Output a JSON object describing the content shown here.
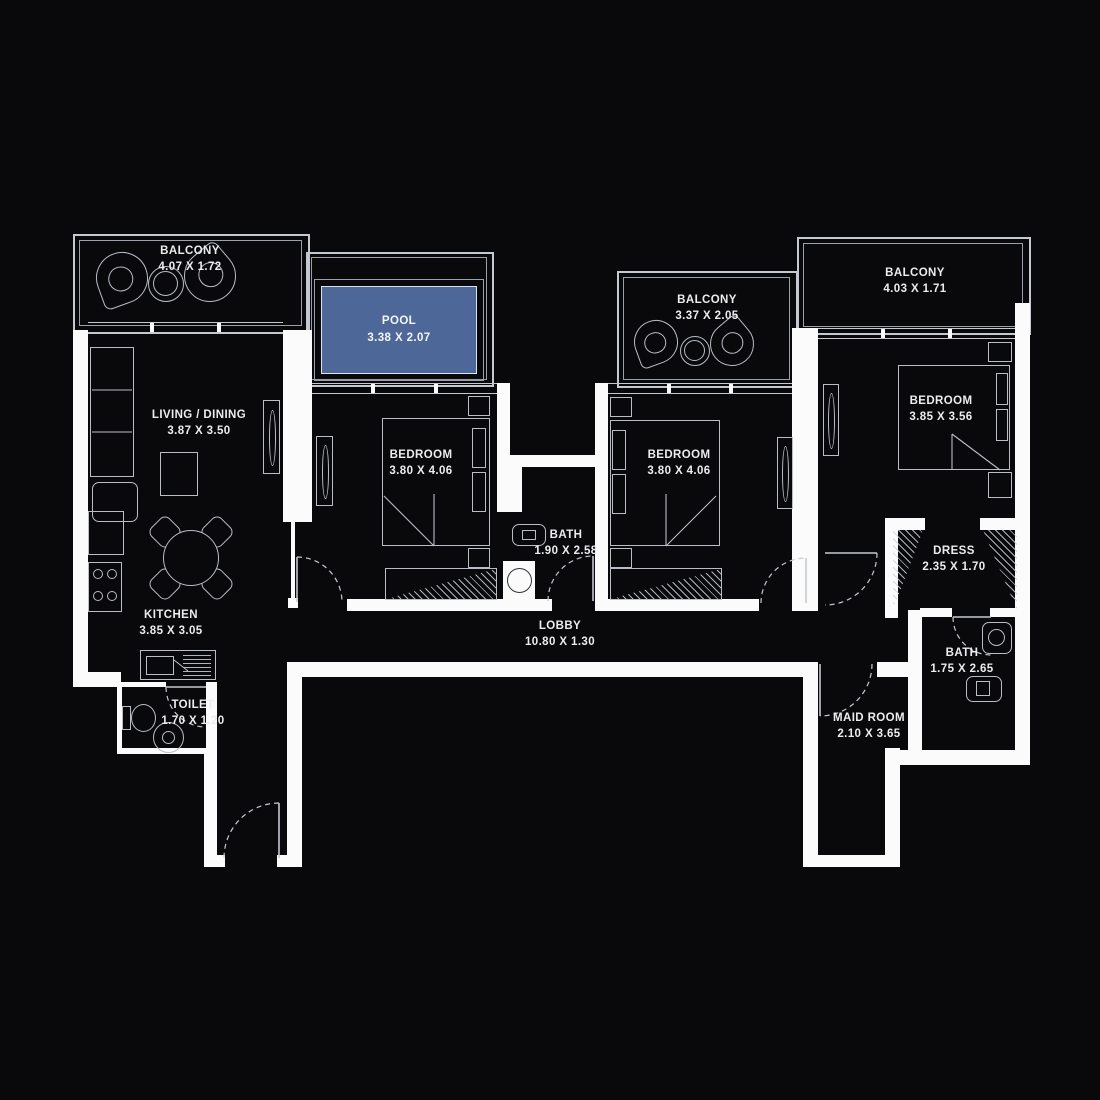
{
  "title": "Apartment Floor Plan",
  "colors": {
    "background": "#09090b",
    "walls": "#fbfbfc",
    "lines": "#c4c9d1",
    "pool_fill": "#4c6798",
    "text": "#ececef"
  },
  "rooms": {
    "balcony_left": {
      "name": "BALCONY",
      "dims": "4.07 X 1.72"
    },
    "pool": {
      "name": "POOL",
      "dims": "3.38 X 2.07"
    },
    "balcony_middle": {
      "name": "BALCONY",
      "dims": "3.37 X 2.05"
    },
    "balcony_right": {
      "name": "BALCONY",
      "dims": "4.03 X 1.71"
    },
    "living_dining": {
      "name": "LIVING / DINING",
      "dims": "3.87 X 3.50"
    },
    "bedroom_1": {
      "name": "BEDROOM",
      "dims": "3.80 X 4.06"
    },
    "bedroom_2": {
      "name": "BEDROOM",
      "dims": "3.80 X 4.06"
    },
    "bedroom_3": {
      "name": "BEDROOM",
      "dims": "3.85 X 3.56"
    },
    "bath_1": {
      "name": "BATH",
      "dims": "1.90 X 2.58"
    },
    "bath_2": {
      "name": "BATH",
      "dims": "1.75 X 2.65"
    },
    "kitchen": {
      "name": "KITCHEN",
      "dims": "3.85 X 3.05"
    },
    "toilet": {
      "name": "TOILET",
      "dims": "1.70 X 1.20"
    },
    "lobby": {
      "name": "LOBBY",
      "dims": "10.80 X 1.30"
    },
    "dress": {
      "name": "DRESS",
      "dims": "2.35 X 1.70"
    },
    "maid_room": {
      "name": "MAID ROOM",
      "dims": "2.10 X 3.65"
    }
  }
}
